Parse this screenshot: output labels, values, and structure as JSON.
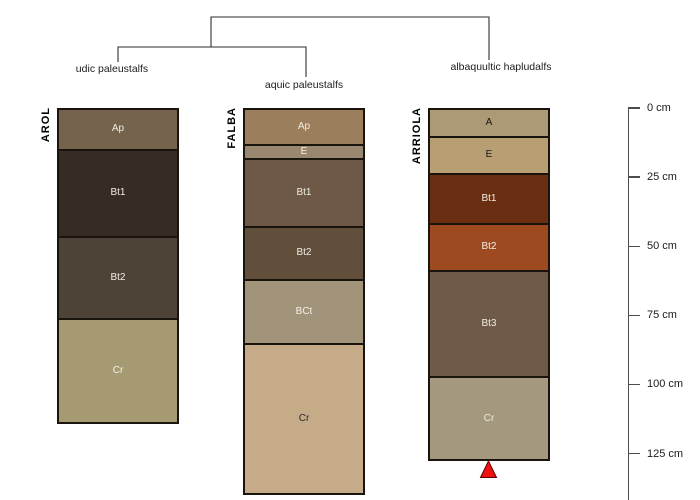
{
  "figure": {
    "background": "#ffffff",
    "dendrogram_line_color": "#2e2e2e",
    "axis_color": "#4d4d4d"
  },
  "dendrogram": {
    "labels": [
      {
        "text": "udic paleustalfs"
      },
      {
        "text": "aquic paleustalfs"
      },
      {
        "text": "albaquultic hapludalfs"
      }
    ]
  },
  "profiles": [
    {
      "name": "AROL",
      "classification": "udic paleustalfs",
      "horizons": [
        {
          "label": "Ap",
          "height_px": 40,
          "color": "#75634e",
          "label_color": "#f1ece2"
        },
        {
          "label": "Bt1",
          "height_px": 88,
          "color": "#362c24",
          "label_color": "#f1ece2"
        },
        {
          "label": "Bt2",
          "height_px": 83,
          "color": "#4e4337",
          "label_color": "#f1ece2"
        },
        {
          "label": "Cr",
          "height_px": 105,
          "color": "#a69a73",
          "label_color": "#f5f2e6"
        }
      ]
    },
    {
      "name": "FALBA",
      "classification": "aquic paleustalfs",
      "horizons": [
        {
          "label": "Ap",
          "height_px": 35,
          "color": "#9b7e5b",
          "label_color": "#f1ece2"
        },
        {
          "label": "E",
          "height_px": 13,
          "color": "#99876f",
          "label_color": "#f5f2ea"
        },
        {
          "label": "Bt1",
          "height_px": 68,
          "color": "#6d5946",
          "label_color": "#f1ece2"
        },
        {
          "label": "Bt2",
          "height_px": 53,
          "color": "#624f3b",
          "label_color": "#f1ece2"
        },
        {
          "label": "BCt",
          "height_px": 64,
          "color": "#a1947b",
          "label_color": "#f3f0e8"
        },
        {
          "label": "Cr",
          "height_px": 154,
          "color": "#c5ab88",
          "label_color": "#2b2b2b"
        }
      ]
    },
    {
      "name": "ARRIOLA",
      "classification": "albaquultic hapludalfs",
      "horizons": [
        {
          "label": "A",
          "height_px": 27,
          "color": "#ac9976",
          "label_color": "#161616"
        },
        {
          "label": "E",
          "height_px": 36,
          "color": "#b89e73",
          "label_color": "#161616"
        },
        {
          "label": "Bt1",
          "height_px": 50,
          "color": "#6a2f13",
          "label_color": "#f1ece2"
        },
        {
          "label": "Bt2",
          "height_px": 47,
          "color": "#9e4a20",
          "label_color": "#f1ece2"
        },
        {
          "label": "Bt3",
          "height_px": 109,
          "color": "#6e5a47",
          "label_color": "#f1ece2"
        },
        {
          "label": "Cr",
          "height_px": 84,
          "color": "#a4987e",
          "label_color": "#ebe8df"
        }
      ],
      "marker": {
        "name": "water-table-triangle",
        "color": "#ee1111"
      }
    }
  ],
  "depth_scale": {
    "unit": "cm",
    "ticks": [
      {
        "label": "0 cm",
        "cm": 0
      },
      {
        "label": "25 cm",
        "cm": 25
      },
      {
        "label": "50 cm",
        "cm": 50
      },
      {
        "label": "75 cm",
        "cm": 75
      },
      {
        "label": "100 cm",
        "cm": 100
      },
      {
        "label": "125 cm",
        "cm": 125
      }
    ]
  }
}
